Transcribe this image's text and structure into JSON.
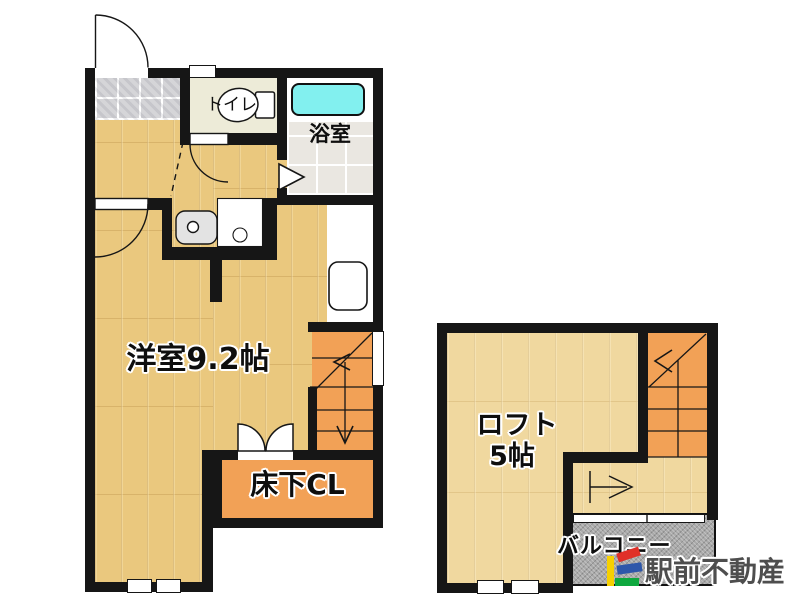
{
  "document": {
    "type": "apartment-floor-plan"
  },
  "labels": {
    "main_room": "洋室9.2帖",
    "toilet": "トイレ",
    "bathroom": "浴室",
    "underfloor_closet": "床下CL",
    "loft": "ロフト",
    "loft_size": "5帖",
    "balcony": "バルコニー"
  },
  "branding": {
    "company": "駅前不動産"
  },
  "colors": {
    "wall": "#161616",
    "wood_floor": "#eac87e",
    "loft_floor": "#f0d89f",
    "stairs_orange": "#f2a156",
    "bathtub_cyan": "#82f0ef",
    "entrance_tile": "#d5d5d8",
    "bathroom_floor": "#eae7e1",
    "toilet_floor": "#edebd8",
    "balcony_concrete": "#a9a9a9",
    "logo_yellow": "#f6d000",
    "logo_red": "#e03028",
    "logo_blue": "#2e57aa",
    "logo_green": "#0ea83e",
    "logo_text": "#4e4e4e"
  }
}
